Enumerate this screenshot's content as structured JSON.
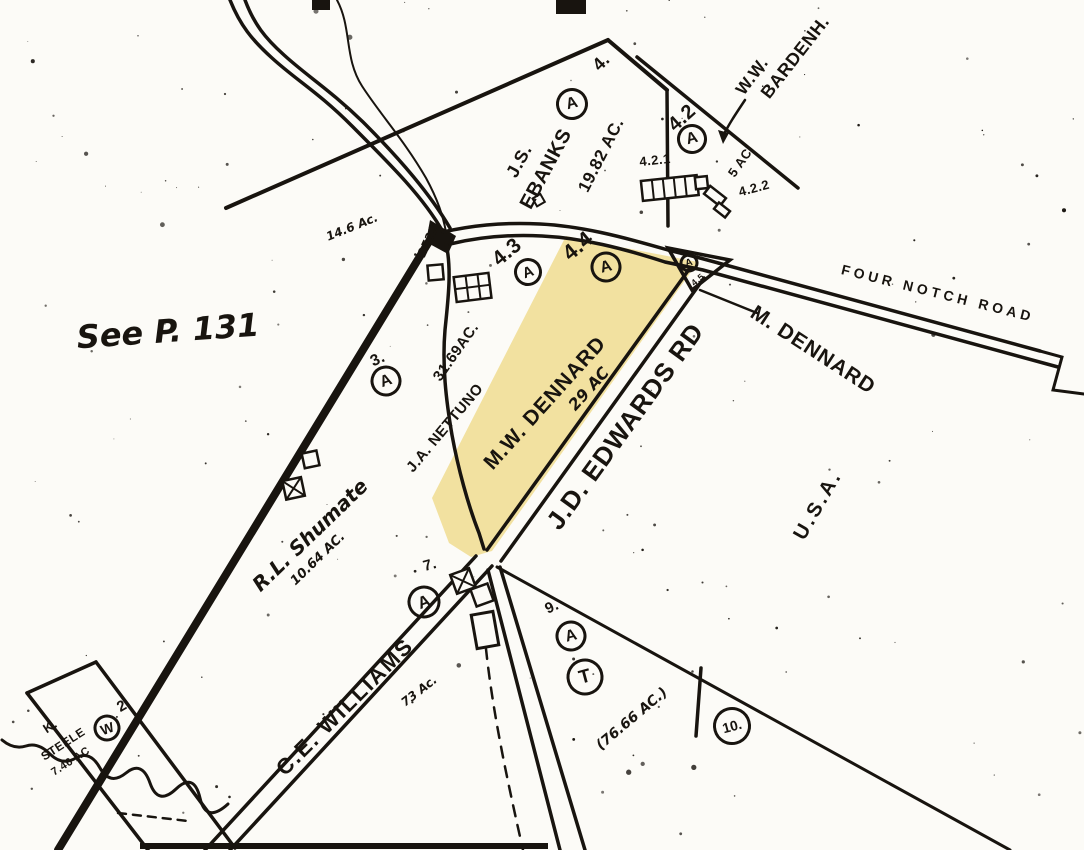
{
  "map": {
    "description_note": "See P. 131",
    "highlighted_parcel_owner": "M.W. DENNARD",
    "highlighted_parcel_acreage": "29 AC"
  },
  "colors": {
    "ink": "#18140f",
    "paper": "#fcfbf7",
    "highlight": "#f2e1a0"
  },
  "roads": [
    {
      "name": "FOUR NOTCH ROAD"
    },
    {
      "name": "J.D. EDWARDS RD"
    }
  ],
  "labels": [
    {
      "id": "see-page-note",
      "text": "See P. 131",
      "x": 168,
      "y": 331,
      "rot": -4,
      "size": 32,
      "cls": "hand"
    },
    {
      "id": "parcel-4-label",
      "text": "4.",
      "x": 601,
      "y": 62,
      "rot": -45,
      "size": 18
    },
    {
      "id": "owner-js-ebanks-line1",
      "text": "J.S.",
      "x": 519,
      "y": 161,
      "rot": -62,
      "size": 18
    },
    {
      "id": "owner-js-ebanks-line2",
      "text": "EBANKS",
      "x": 546,
      "y": 169,
      "rot": -62,
      "size": 20
    },
    {
      "id": "ebanks-acreage",
      "text": "19.82 AC.",
      "x": 601,
      "y": 155,
      "rot": -63,
      "size": 17
    },
    {
      "id": "parcel-42-label",
      "text": "4.2",
      "x": 682,
      "y": 118,
      "rot": -42,
      "size": 20
    },
    {
      "id": "parcel-421-label",
      "text": "4.2.1",
      "x": 655,
      "y": 160,
      "rot": -6,
      "size": 13
    },
    {
      "id": "parcel-422-acreage",
      "text": "5 AC.",
      "x": 741,
      "y": 161,
      "rot": -55,
      "size": 13
    },
    {
      "id": "parcel-422-label",
      "text": "4.2.2",
      "x": 754,
      "y": 188,
      "rot": -15,
      "size": 13
    },
    {
      "id": "owner-ww-bardenh-line1",
      "text": "W.W.",
      "x": 752,
      "y": 76,
      "rot": -53,
      "size": 17
    },
    {
      "id": "owner-ww-bardenh-line2",
      "text": "BARDENH.",
      "x": 795,
      "y": 57,
      "rot": -52,
      "size": 18
    },
    {
      "id": "acreage-14-6",
      "text": "14.6 Ac.",
      "x": 352,
      "y": 227,
      "rot": -22,
      "size": 12,
      "cls": "hand"
    },
    {
      "id": "road-number-2522",
      "text": "2522",
      "x": 428,
      "y": 241,
      "rot": -65,
      "size": 12,
      "cls": "hand"
    },
    {
      "id": "parcel-43-label",
      "text": "4.3",
      "x": 507,
      "y": 252,
      "rot": -40,
      "size": 21
    },
    {
      "id": "parcel-44-label",
      "text": "4.4",
      "x": 578,
      "y": 246,
      "rot": -40,
      "size": 22
    },
    {
      "id": "parcel-45-label",
      "text": "4.5",
      "x": 698,
      "y": 280,
      "rot": -40,
      "size": 9
    },
    {
      "id": "owner-m-dennard-callout",
      "text": "M. DENNARD",
      "x": 813,
      "y": 350,
      "rot": 33,
      "size": 21,
      "ls": 1
    },
    {
      "id": "four-notch-road-name",
      "text": "FOUR NOTCH ROAD",
      "x": 938,
      "y": 293,
      "rot": 14,
      "size": 14,
      "ls": 4
    },
    {
      "id": "parcel-3-label",
      "text": "3.",
      "x": 378,
      "y": 360,
      "rot": -25,
      "size": 16
    },
    {
      "id": "nettuno-acreage",
      "text": "31.69AC.",
      "x": 456,
      "y": 352,
      "rot": -55,
      "size": 15
    },
    {
      "id": "owner-ja-nettuno",
      "text": "J.A. NETTUNO",
      "x": 445,
      "y": 428,
      "rot": -50,
      "size": 15
    },
    {
      "id": "owner-mw-dennard",
      "text": "M.W. DENNARD",
      "x": 545,
      "y": 403,
      "rot": -48,
      "size": 21,
      "ls": 1
    },
    {
      "id": "mw-dennard-acreage",
      "text": "29 AC",
      "x": 589,
      "y": 389,
      "rot": -48,
      "size": 16,
      "cls": "hand"
    },
    {
      "id": "jd-edwards-road-name",
      "text": "J.D. EDWARDS RD",
      "x": 625,
      "y": 426,
      "rot": -54,
      "size": 26,
      "ls": 1
    },
    {
      "id": "owner-usa",
      "text": "U.S.A.",
      "x": 818,
      "y": 505,
      "rot": -60,
      "size": 20,
      "ls": 3
    },
    {
      "id": "owner-rl-shumate",
      "text": "R.L. Shumate",
      "x": 310,
      "y": 535,
      "rot": -44,
      "size": 20,
      "cls": "hand"
    },
    {
      "id": "shumate-acreage",
      "text": "10.64 AC.",
      "x": 318,
      "y": 559,
      "rot": -44,
      "size": 13,
      "cls": "hand"
    },
    {
      "id": "parcel-7-label",
      "text": "7.",
      "x": 430,
      "y": 565,
      "rot": -15,
      "size": 15
    },
    {
      "id": "parcel-9-label",
      "text": "9.",
      "x": 552,
      "y": 607,
      "rot": -25,
      "size": 15
    },
    {
      "id": "acreage-76-66",
      "text": "(76.66 AC.)",
      "x": 632,
      "y": 719,
      "rot": -40,
      "size": 14,
      "cls": "hand"
    },
    {
      "id": "owner-ce-williams",
      "text": "C.E. WILLIAMS",
      "x": 345,
      "y": 707,
      "rot": -45,
      "size": 22,
      "ls": 2
    },
    {
      "id": "williams-acreage",
      "text": "73 Ac.",
      "x": 419,
      "y": 691,
      "rot": -38,
      "size": 12,
      "cls": "hand"
    },
    {
      "id": "owner-k-steele-line1",
      "text": "K.",
      "x": 50,
      "y": 726,
      "rot": -33,
      "size": 13
    },
    {
      "id": "owner-k-steele-line2",
      "text": "STEELE",
      "x": 63,
      "y": 744,
      "rot": -33,
      "size": 12
    },
    {
      "id": "steele-acreage",
      "text": "7.46 AC",
      "x": 71,
      "y": 762,
      "rot": -33,
      "size": 11
    },
    {
      "id": "parcel-2-label",
      "text": "2.",
      "x": 124,
      "y": 705,
      "rot": -30,
      "size": 15
    }
  ],
  "markers": [
    {
      "id": "marker-a-ebanks",
      "letter": "A",
      "x": 572,
      "y": 104,
      "d": 32,
      "fs": 16,
      "rot": -15
    },
    {
      "id": "marker-a-42",
      "letter": "A",
      "x": 692,
      "y": 139,
      "d": 30,
      "fs": 16,
      "rot": -15
    },
    {
      "id": "marker-a-43",
      "letter": "A",
      "x": 528,
      "y": 272,
      "d": 28,
      "fs": 15,
      "rot": -20
    },
    {
      "id": "marker-a-44",
      "letter": "A",
      "x": 606,
      "y": 267,
      "d": 31,
      "fs": 16,
      "rot": -15
    },
    {
      "id": "marker-a-45",
      "letter": "A",
      "x": 689,
      "y": 263,
      "d": 19,
      "fs": 10,
      "rot": -15
    },
    {
      "id": "marker-a-3",
      "letter": "A",
      "x": 386,
      "y": 381,
      "d": 31,
      "fs": 16,
      "rot": -20
    },
    {
      "id": "marker-a-7",
      "letter": "A",
      "x": 424,
      "y": 602,
      "d": 33,
      "fs": 17,
      "rot": -20
    },
    {
      "id": "marker-a-9",
      "letter": "A",
      "x": 571,
      "y": 636,
      "d": 31,
      "fs": 16,
      "rot": -15
    },
    {
      "id": "marker-t-9",
      "letter": "T",
      "x": 585,
      "y": 677,
      "d": 37,
      "fs": 19,
      "rot": -15
    },
    {
      "id": "marker-w-steele",
      "letter": "W",
      "x": 107,
      "y": 728,
      "d": 27,
      "fs": 14,
      "rot": -20
    },
    {
      "id": "marker-10",
      "letter": "10.",
      "x": 732,
      "y": 726,
      "d": 38,
      "fs": 14,
      "rot": -15
    }
  ]
}
